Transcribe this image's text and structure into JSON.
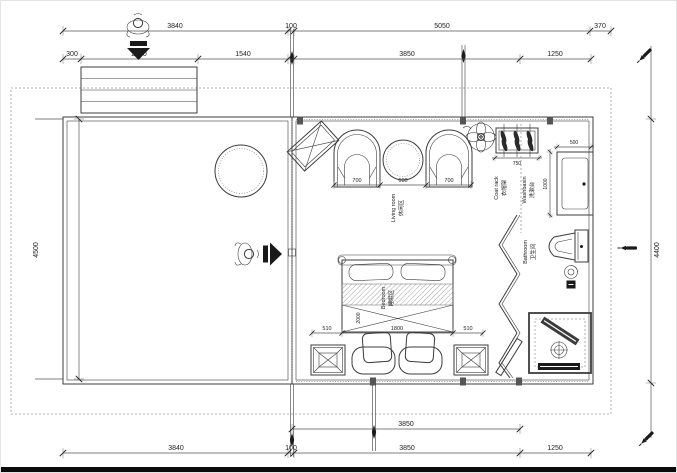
{
  "drawing_type": "residential floor plan (CAD)",
  "dimensions": {
    "top_row_outer": [
      "3840",
      "100",
      "5050",
      "370"
    ],
    "top_row_inner": [
      "300",
      "2000",
      "1540",
      "3850",
      "1250"
    ],
    "left_height": "4500",
    "right_height": "4400",
    "bottom_row_inner": [
      "3850"
    ],
    "bottom_row_outer": [
      "3840",
      "100",
      "3850",
      "1250"
    ],
    "living_furniture": [
      "700",
      "600",
      "700"
    ],
    "coat_rack_width": "750",
    "washbasin_width": "500",
    "washbasin_depth": "1000",
    "bed_row": [
      "510",
      "1800",
      "510"
    ],
    "bed_length": "2000"
  },
  "labels": {
    "living_room": {
      "zh": "休闲区",
      "en": "Living room"
    },
    "bedroom": {
      "zh": "睡眠区",
      "en": "Bedroom"
    },
    "coat_rack": {
      "zh": "衣帽架",
      "en": "Coat rack"
    },
    "washbasin": {
      "zh": "洗漱台",
      "en": "Washbasin"
    },
    "bathroom": {
      "zh": "卫生间",
      "en": "Bathroom"
    }
  },
  "icons": {
    "person": "top-view person figure",
    "entry_arrow": "solid black entry direction arrow",
    "ceiling_fan": "circle with four blades",
    "pen_marker": "small pen/marker annotation",
    "hanger": "clothes hanger on rack",
    "floor_drain": "round drain with cross",
    "shower_drain": "round drain in shower pan"
  },
  "colors": {
    "line": "#3c3c3c",
    "dim_text": "#222222",
    "dash": "#9b9b9b",
    "dark_fill": "#1a1a1a",
    "background": "#ffffff"
  }
}
